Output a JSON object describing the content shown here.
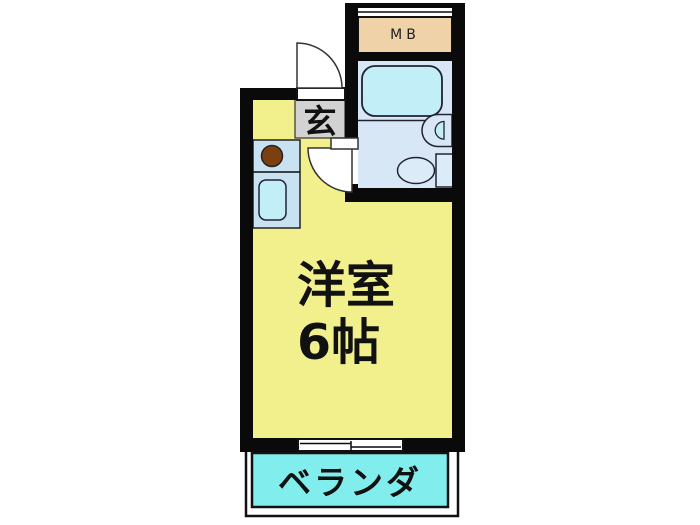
{
  "floor_plan": {
    "labels": {
      "meter_box": "MB",
      "entrance": "玄",
      "main_room_line1": "洋室",
      "main_room_line2": "6帖",
      "veranda": "ベランダ"
    },
    "colors": {
      "wall": "#0a0a0a",
      "room_yellow": "#f2ef8d",
      "bath_floor_blue": "#d7e7f5",
      "toilet_blue": "#dcebf8",
      "fixture_cyan": "#c2eff7",
      "veranda_cyan": "#82eded",
      "meter_box_tan": "#f0d2a8",
      "entrance_gray": "#d2d2d2",
      "counter_blue": "#c9e2f2",
      "stove_brown": "#7b3f10",
      "white": "#ffffff"
    }
  }
}
